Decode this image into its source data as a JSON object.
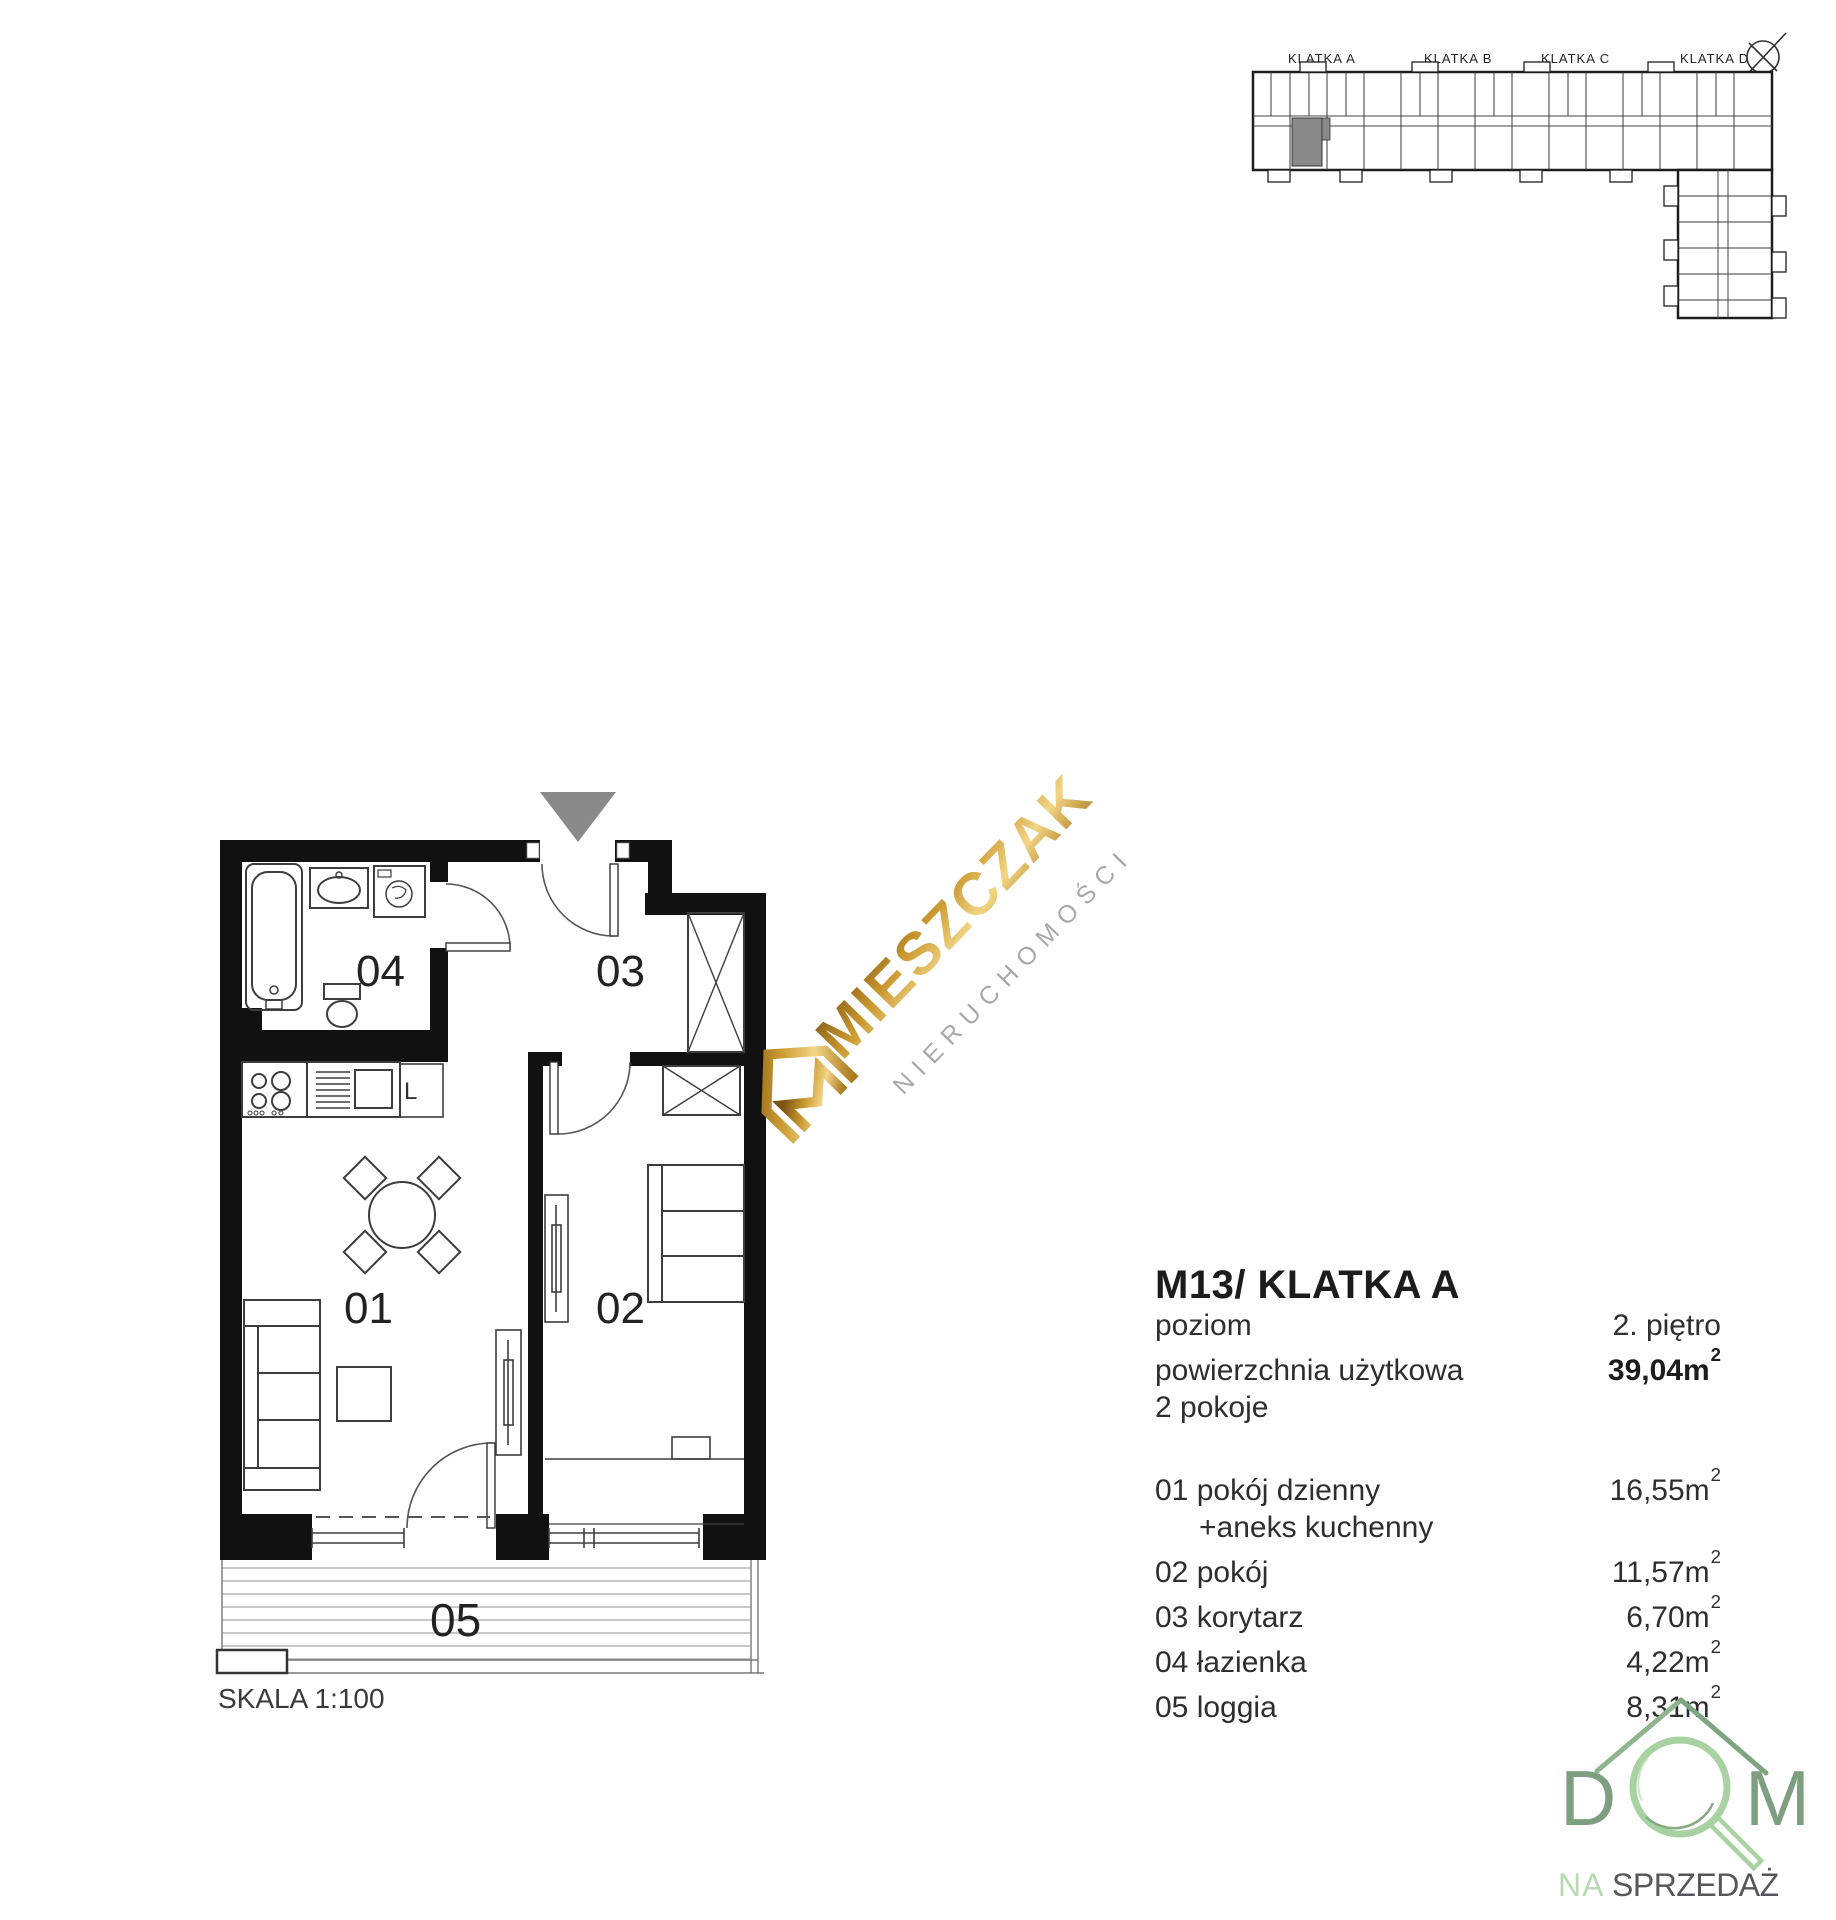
{
  "page": {
    "background": "#ffffff"
  },
  "overview": {
    "labels": [
      {
        "text": "KLATKA A"
      },
      {
        "text": "KLATKA B"
      },
      {
        "text": "KLATKA C"
      },
      {
        "text": "KLATKA D"
      }
    ],
    "highlight_color": "#8a8a8a",
    "icons": {
      "compass": "compass-north-icon"
    }
  },
  "plan": {
    "entrance_marker_color": "#8a8a8a",
    "rooms": [
      {
        "id": "01"
      },
      {
        "id": "02"
      },
      {
        "id": "03"
      },
      {
        "id": "04"
      },
      {
        "id": "05"
      }
    ],
    "fridge_label": "L",
    "scale_label": "SKALA 1:100"
  },
  "watermark": {
    "brand": "MIESZCZAK",
    "subtitle": "NIERUCHOMOŚCI",
    "gold": "#c9982f",
    "gray": "#a8a8a8"
  },
  "details": {
    "title": "M13/ KLATKA A",
    "rows": [
      {
        "label": "poziom",
        "value": "2. piętro"
      },
      {
        "label": "powierzchnia użytkowa",
        "value": "39,04m",
        "sup": "2"
      },
      {
        "label": "2 pokoje",
        "value": ""
      }
    ],
    "room_rows": [
      {
        "label": "01 pokój dzienny",
        "value": "16,55m",
        "sup": "2"
      },
      {
        "label": "+aneks kuchenny",
        "value": ""
      },
      {
        "label": "02 pokój",
        "value": "11,57m",
        "sup": "2"
      },
      {
        "label": "03 korytarz",
        "value": "6,70m",
        "sup": "2"
      },
      {
        "label": "04 łazienka",
        "value": "4,22m",
        "sup": "2"
      },
      {
        "label": "05 loggia",
        "value": "8,31m",
        "sup": "2"
      }
    ]
  },
  "footer_logo": {
    "letter_d": "D",
    "letter_m": "M",
    "tagline_na": "NA",
    "tagline_rest": "SPRZEDAŻ",
    "green_dark": "#7d9f7f",
    "green_light": "#a9d2a2"
  }
}
